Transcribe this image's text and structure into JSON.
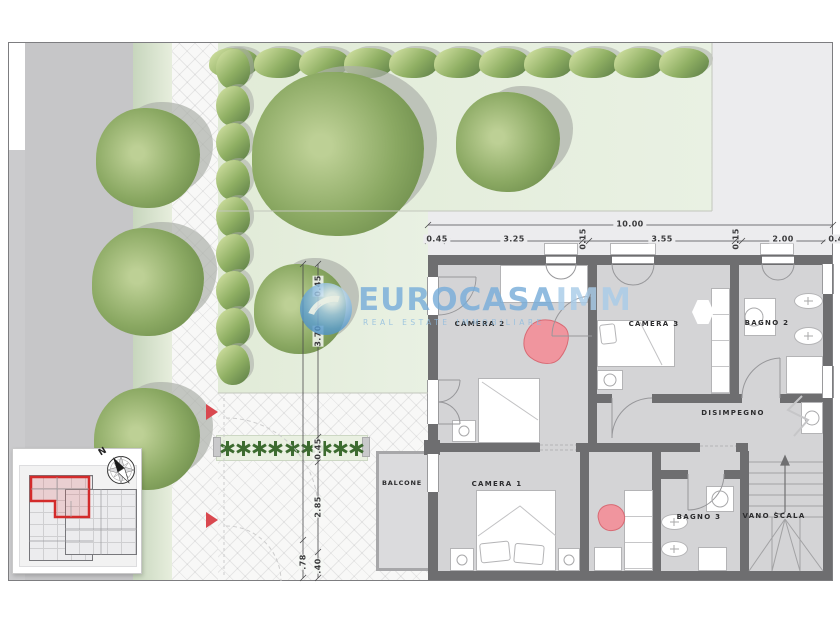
{
  "watermark": {
    "brand": "EUROCASA",
    "suffix": "IMM",
    "tagline": "REAL ESTATE IMMOBILIARE"
  },
  "rooms": {
    "camera2": "CAMERA 2",
    "camera3": "CAMERA 3",
    "bagno2": "BAGNO 2",
    "disimpegno": "DISIMPEGNO",
    "camera1": "CAMERA 1",
    "bagno3": "BAGNO 3",
    "vano_scala": "VANO SCALA",
    "balcone": "BALCONE"
  },
  "dimensions": {
    "top_total": "10.00",
    "top_segments": [
      "0.45",
      "3.25",
      "0.15",
      "3.55",
      "0.15",
      "2.00",
      "0.4"
    ],
    "left_segments": [
      "0.45",
      "3.70",
      "0.45",
      "2.85",
      ".40"
    ],
    "left_outer_segment": ".78"
  },
  "compass": {
    "north": "N"
  },
  "colors": {
    "wall": "#6e6e70",
    "floor": "#d4d4d6",
    "garden": "#e4eddc",
    "road": "#c6c6c8",
    "tree": "#85a45f",
    "hedge": "#6d8c4b",
    "accent_red": "#d9484f",
    "watermark_blue": "#79aeda"
  }
}
